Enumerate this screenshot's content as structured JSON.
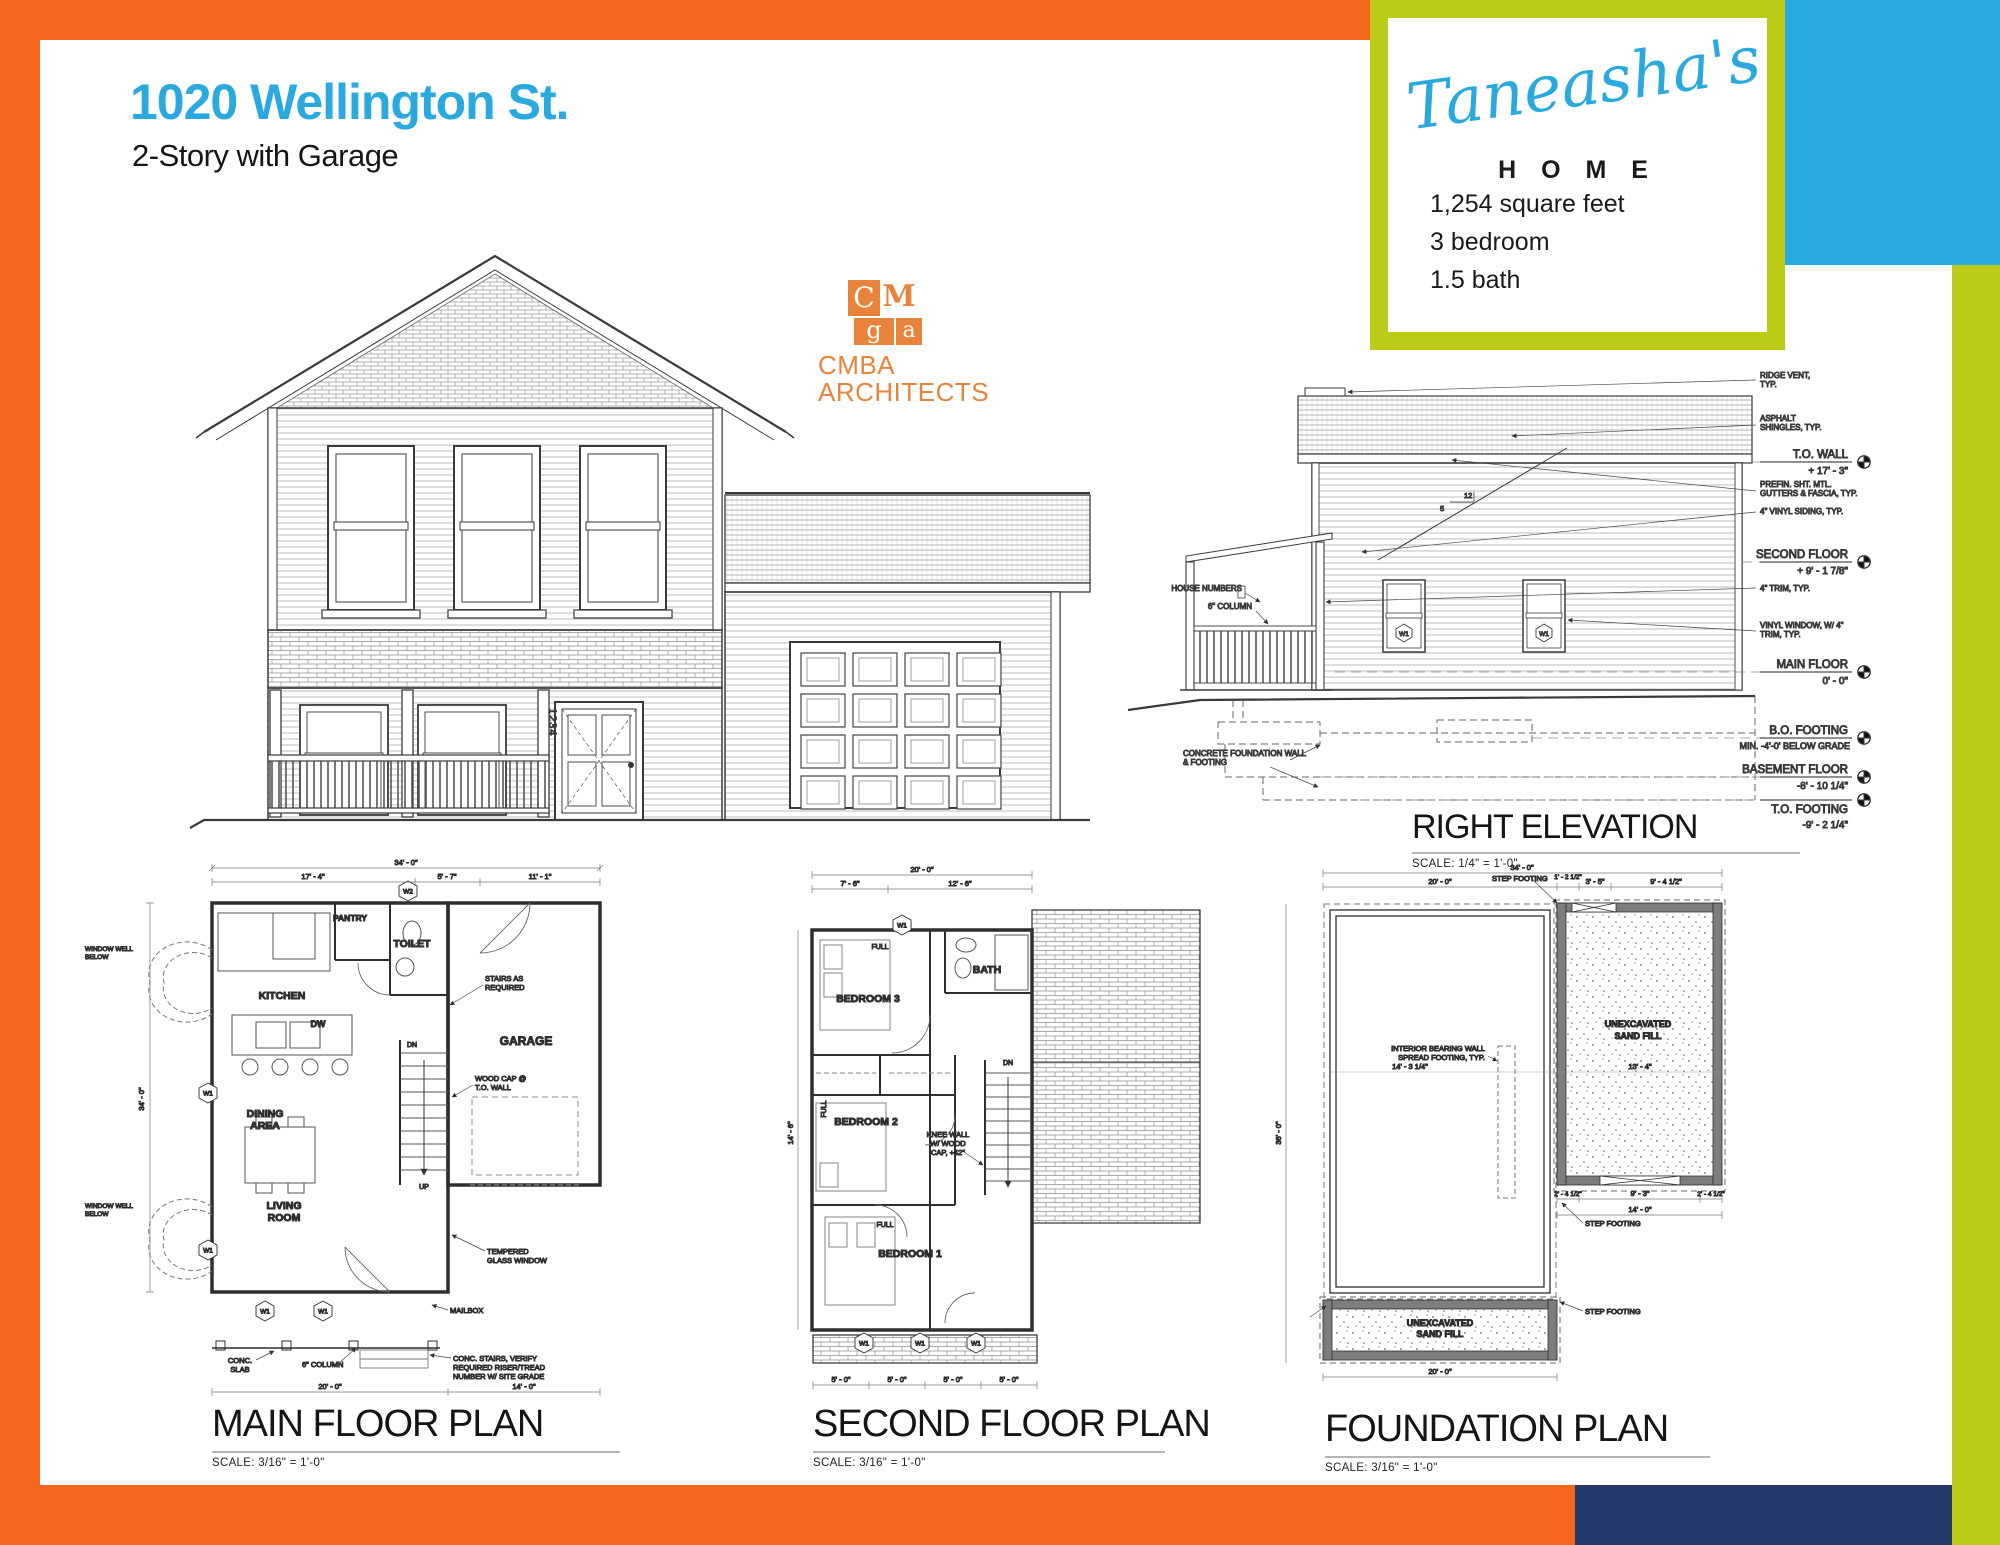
{
  "colors": {
    "frame_orange": "#F5661F",
    "accent_cyan": "#2AA9DE",
    "accent_lime": "#BCCB17",
    "accent_navy": "#24396B",
    "logo_orange": "#E8833C"
  },
  "header": {
    "title": "1020 Wellington St.",
    "subtitle": "2-Story with Garage"
  },
  "badge": {
    "script": "Taneasha's",
    "home": "H O M E",
    "sqft": "1,254 square feet",
    "beds": "3 bedroom",
    "baths": "1.5 bath"
  },
  "logo": {
    "tile1": "C",
    "tile2": "M",
    "tile3": "g",
    "tile4": "a",
    "name": "CMBA",
    "tagline": "ARCHITECTS"
  },
  "front_elevation": {
    "house_number": "1234"
  },
  "right_elevation": {
    "title": "RIGHT ELEVATION",
    "scale": "SCALE:   1/4\" = 1'-0\"",
    "slope_rise": "12",
    "slope_run": "5",
    "window_tag": "W1",
    "notes": {
      "ridge1": "RIDGE VENT,",
      "ridge2": "TYP.",
      "shingles1": "ASPHALT",
      "shingles2": "SHINGLES, TYP.",
      "gutters1": "PREFIN. SHT. MTL.",
      "gutters2": "GUTTERS & FASCIA, TYP.",
      "siding": "4\" VINYL SIDING, TYP.",
      "trim": "4\" TRIM, TYP.",
      "window1": "VINYL WINDOW, W/ 4\"",
      "window2": "TRIM, TYP.",
      "house_numbers": "HOUSE NUMBERS",
      "column": "6\" COLUMN",
      "foundation1": "CONCRETE FOUNDATION WALL",
      "foundation2": "& FOOTING"
    },
    "levels": [
      {
        "label": "T.O. WALL",
        "value": "+ 17' - 3\""
      },
      {
        "label": "SECOND FLOOR",
        "value": "+ 9' - 1 7/8\""
      },
      {
        "label": "MAIN FLOOR",
        "value": "0' - 0\""
      },
      {
        "label": "B.O. FOOTING",
        "value": "MIN. -4'-0' BELOW GRADE"
      },
      {
        "label": "BASEMENT FLOOR",
        "value": "-8' - 10 1/4\""
      },
      {
        "label": "T.O. FOOTING",
        "value": "-9' - 2 1/4\""
      }
    ]
  },
  "main_floor": {
    "title": "MAIN FLOOR PLAN",
    "scale": "SCALE:   3/16\" = 1'-0\"",
    "rooms": {
      "kitchen": "KITCHEN",
      "pantry": "PANTRY",
      "toilet": "TOILET",
      "dining1": "DINING",
      "dining2": "AREA",
      "living1": "LIVING",
      "living2": "ROOM",
      "garage": "GARAGE"
    },
    "notes": {
      "stairs1": "STAIRS AS",
      "stairs2": "REQUIRED",
      "woodcap1": "WOOD CAP @",
      "woodcap2": "T.O. WALL",
      "tempered1": "TEMPERED",
      "tempered2": "GLASS WINDOW",
      "mailbox": "MAILBOX",
      "slab1": "CONC.",
      "slab2": "SLAB",
      "column": "6\" COLUMN",
      "concstairs1": "CONC. STAIRS, VERIFY",
      "concstairs2": "REQUIRED RISER/TREAD",
      "concstairs3": "NUMBER W/ SITE GRADE",
      "well1": "WINDOW WELL",
      "well2": "BELOW",
      "dw": "DW",
      "up": "UP",
      "dn": "DN"
    },
    "dims": {
      "overall": "34' - 0\"",
      "seg1": "17' - 4\"",
      "seg2": "5' - 7\"",
      "seg3": "11' - 1\"",
      "bottom1": "20' - 0\"",
      "bottom2": "14' - 0\"",
      "left": "34' - 0\""
    },
    "tags": {
      "w1": "W1",
      "w2": "W2"
    }
  },
  "second_floor": {
    "title": "SECOND FLOOR PLAN",
    "scale": "SCALE:   3/16\" = 1'-0\"",
    "rooms": {
      "bed3": "BEDROOM 3",
      "bath": "BATH",
      "bed2": "BEDROOM 2",
      "bed1": "BEDROOM 1"
    },
    "notes": {
      "dn": "DN",
      "knee1": "KNEE WALL",
      "knee2": "W/ WOOD",
      "knee3": "CAP, +42\"",
      "full": "FULL"
    },
    "dims": {
      "overall": "20' - 0\"",
      "seg1": "7' - 6\"",
      "seg2": "12' - 6\"",
      "porch": "5' - 0\"",
      "left": "14' - 6\""
    },
    "tags": {
      "w1": "W1"
    }
  },
  "foundation": {
    "title": "FOUNDATION PLAN",
    "scale": "SCALE:   3/16\" = 1'-0\"",
    "notes": {
      "sand1": "UNEXCAVATED",
      "sand2": "SAND FILL",
      "step": "STEP FOOTING",
      "bearing1": "INTERIOR BEARING WALL",
      "bearing2": "SPREAD FOOTING, TYP."
    },
    "dims": {
      "overall": "34' - 0\"",
      "left": "36' - 0\"",
      "seg1": "20' - 0\"",
      "seg2": "1' - 2 1/2\"",
      "seg3": "3' - 5\"",
      "seg4": "9' - 4 1/2\"",
      "mid1": "14' - 3 1/4\"",
      "mid2": "13' - 4\"",
      "bottom": "20' - 0\"",
      "garage_w": "14' - 0\"",
      "g1": "2' - 4 1/2\"",
      "g2": "9' - 3\""
    }
  }
}
